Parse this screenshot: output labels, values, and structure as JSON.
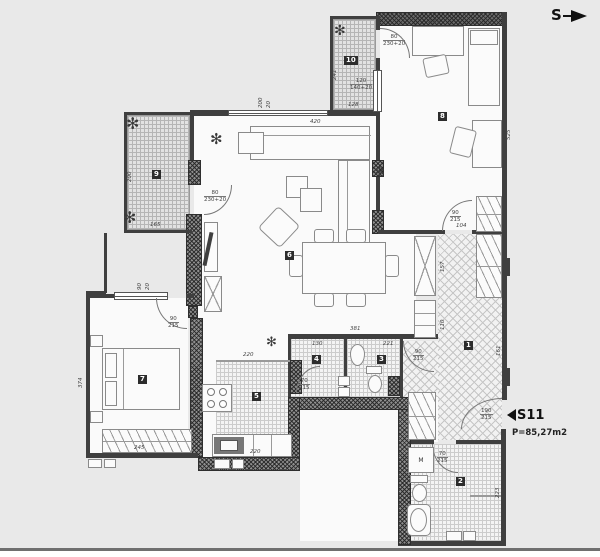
{
  "compass": {
    "label": "S"
  },
  "unit": {
    "id": "S11",
    "area": "P=85,27m2"
  },
  "rooms": {
    "hall": "1",
    "bathroom": "2",
    "wc": "3",
    "storage": "4",
    "kitchen": "5",
    "living": "6",
    "bedroom_main": "7",
    "bedroom_second": "8",
    "terrace_west": "9",
    "terrace_north": "10"
  },
  "fixtures": {
    "washing_machine": "M"
  },
  "dims": {
    "sofa_len": "420",
    "desk_r8": "2.63",
    "r8_right": "525",
    "t10_left": "241",
    "t10_bottom": "128",
    "t10_door_w": "80",
    "t10_door_h": "230+20",
    "t10_win_w": "120",
    "t10_win_h": "140+20",
    "lr_door_w": "80",
    "lr_door_h": "230+20",
    "lr_win_a": "200",
    "lr_win_b": "20",
    "t9_left": "200",
    "t9_bottom": "165",
    "b7_left": "374",
    "b7_bottom": "245",
    "b7_door_w": "90",
    "b7_door_h": "215",
    "b7_win_a": "90",
    "b7_win_b": "20",
    "r8_door_w": "90",
    "r8_door_h": "215",
    "hall_top": "104",
    "hall_mid": "157",
    "hall_low": "110",
    "hall_right": "161",
    "bath_top": "381",
    "r4_w": "130",
    "r3_w": "221",
    "r4_door_w": "70",
    "r4_door_h": "215",
    "wc_door_w": "90",
    "wc_door_h": "215",
    "b2_door_w": "70",
    "b2_door_h": "215",
    "kitchen_top": "220",
    "kitchen_sink": "220",
    "b2_right": "223",
    "entry_w": "190",
    "entry_h": "215"
  }
}
